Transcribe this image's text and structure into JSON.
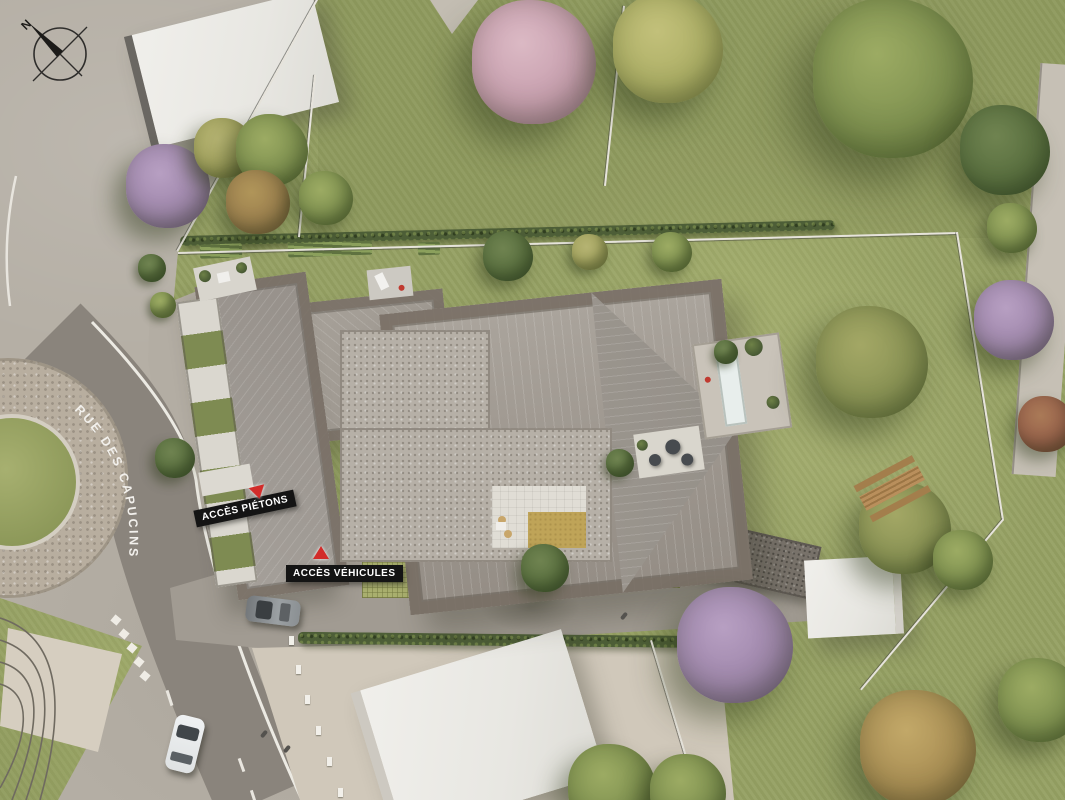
{
  "compass": {
    "letter": "N"
  },
  "street": {
    "name": "RUE DES CAPUCINS"
  },
  "access_labels": {
    "pedestrian": "ACCÈS PIÉTONS",
    "vehicle": "ACCÈS VÉHICULES"
  },
  "colors": {
    "road_asphalt": "#8a847c",
    "pavement": "#b5afa5",
    "sidewalk_beige": "#d0c8ba",
    "grass": "#96a164",
    "hedge": "#4d5e37",
    "roof_metal": "#a29c94",
    "roof_flat_gravel": "#b6b0a7",
    "permeable_paving": "#a9af6e",
    "lawn_square_yellow": "#bfa458",
    "marker_red": "#d22c2a",
    "label_bg": "#141414",
    "label_text": "#ffffff",
    "building_white": "#e9e8e4",
    "pool_water": "#e8eeec"
  },
  "scene": {
    "tree_palette": {
      "green": [
        "#7f9150",
        "#5c7038",
        "#9cab63"
      ],
      "darkgreen": [
        "#5a7040",
        "#3f5530",
        "#6f8350"
      ],
      "olive": [
        "#a3a35f",
        "#7e8447",
        "#b5b372"
      ],
      "brown": [
        "#9b7f4e",
        "#7a5f3a",
        "#b09559"
      ],
      "purple": [
        "#9f87ab",
        "#7c6488",
        "#b79fc2"
      ],
      "pink": [
        "#c79fae",
        "#a87f93",
        "#dbb9c4"
      ],
      "yellowgreen": [
        "#adaf66",
        "#8a8e4d",
        "#c2c07a"
      ],
      "autumn": [
        "#a98e54",
        "#82683c",
        "#c2a868"
      ],
      "red": [
        "#96604a",
        "#744936",
        "#aa7a57"
      ],
      "mixed": [
        "#8a9355",
        "#67763f",
        "#a3a765"
      ]
    },
    "trees": [
      {
        "x": 168,
        "y": 186,
        "r": 42,
        "t": "purple"
      },
      {
        "x": 224,
        "y": 148,
        "r": 30,
        "t": "olive"
      },
      {
        "x": 272,
        "y": 150,
        "r": 36,
        "t": "green"
      },
      {
        "x": 258,
        "y": 202,
        "r": 32,
        "t": "brown"
      },
      {
        "x": 326,
        "y": 198,
        "r": 27,
        "t": "green"
      },
      {
        "x": 534,
        "y": 62,
        "r": 62,
        "t": "pink"
      },
      {
        "x": 668,
        "y": 48,
        "r": 55,
        "t": "yellowgreen"
      },
      {
        "x": 893,
        "y": 78,
        "r": 80,
        "t": "green"
      },
      {
        "x": 1005,
        "y": 150,
        "r": 45,
        "t": "darkgreen"
      },
      {
        "x": 1012,
        "y": 228,
        "r": 25,
        "t": "green"
      },
      {
        "x": 1014,
        "y": 320,
        "r": 40,
        "t": "purple"
      },
      {
        "x": 1046,
        "y": 424,
        "r": 28,
        "t": "red"
      },
      {
        "x": 508,
        "y": 256,
        "r": 25,
        "t": "darkgreen"
      },
      {
        "x": 590,
        "y": 252,
        "r": 18,
        "t": "olive"
      },
      {
        "x": 672,
        "y": 252,
        "r": 20,
        "t": "green"
      },
      {
        "x": 872,
        "y": 362,
        "r": 56,
        "t": "mixed"
      },
      {
        "x": 905,
        "y": 528,
        "r": 46,
        "t": "mixed"
      },
      {
        "x": 963,
        "y": 560,
        "r": 30,
        "t": "green"
      },
      {
        "x": 735,
        "y": 645,
        "r": 58,
        "t": "purple"
      },
      {
        "x": 612,
        "y": 788,
        "r": 44,
        "t": "green"
      },
      {
        "x": 688,
        "y": 792,
        "r": 38,
        "t": "green"
      },
      {
        "x": 918,
        "y": 748,
        "r": 58,
        "t": "autumn"
      },
      {
        "x": 1040,
        "y": 700,
        "r": 42,
        "t": "green"
      },
      {
        "x": 175,
        "y": 458,
        "r": 20,
        "t": "darkgreen"
      },
      {
        "x": 152,
        "y": 268,
        "r": 14,
        "t": "darkgreen"
      },
      {
        "x": 163,
        "y": 305,
        "r": 13,
        "t": "green"
      },
      {
        "x": 545,
        "y": 568,
        "r": 24,
        "t": "darkgreen"
      },
      {
        "x": 620,
        "y": 463,
        "r": 14,
        "t": "darkgreen"
      },
      {
        "x": 726,
        "y": 352,
        "r": 12,
        "t": "darkgreen"
      }
    ],
    "skylights": [
      {
        "x": 505,
        "y": 316
      },
      {
        "x": 425,
        "y": 316
      },
      {
        "x": 612,
        "y": 316
      },
      {
        "x": 656,
        "y": 318
      },
      {
        "x": 717,
        "y": 348
      },
      {
        "x": 570,
        "y": 460
      },
      {
        "x": 612,
        "y": 460
      },
      {
        "x": 262,
        "y": 430
      },
      {
        "x": 312,
        "y": 430
      }
    ],
    "fences": [
      {
        "x1": 178,
        "y1": 252,
        "x2": 958,
        "y2": 232
      },
      {
        "x1": 958,
        "y1": 232,
        "x2": 1004,
        "y2": 520
      },
      {
        "x1": 1004,
        "y1": 520,
        "x2": 862,
        "y2": 690
      },
      {
        "x1": 652,
        "y1": 640,
        "x2": 700,
        "y2": 800
      },
      {
        "x1": 316,
        "y1": 75,
        "x2": 300,
        "y2": 237
      },
      {
        "x1": 625,
        "y1": 6,
        "x2": 606,
        "y2": 186
      },
      {
        "x1": 318,
        "y1": 0,
        "x2": 178,
        "y2": 252
      }
    ],
    "garden_beds": [
      {
        "x": 200,
        "y": 244,
        "w": 42,
        "h": 14
      },
      {
        "x": 288,
        "y": 242,
        "w": 84,
        "h": 14
      },
      {
        "x": 418,
        "y": 242,
        "w": 22,
        "h": 13
      }
    ],
    "fence_posts": [
      {
        "x": 289,
        "y": 636
      },
      {
        "x": 296,
        "y": 665
      },
      {
        "x": 305,
        "y": 695
      },
      {
        "x": 316,
        "y": 726
      },
      {
        "x": 327,
        "y": 757
      },
      {
        "x": 338,
        "y": 788
      }
    ],
    "road_checkers": [
      {
        "x": 112,
        "y": 616
      },
      {
        "x": 120,
        "y": 630
      },
      {
        "x": 128,
        "y": 644
      },
      {
        "x": 135,
        "y": 658
      },
      {
        "x": 141,
        "y": 672
      }
    ],
    "road_dashes": [
      {
        "x": 168,
        "y": 690,
        "a": 72,
        "l": 16
      },
      {
        "x": 178,
        "y": 722,
        "a": 74,
        "l": 16
      },
      {
        "x": 188,
        "y": 754,
        "a": 76,
        "l": 16
      },
      {
        "x": 240,
        "y": 758,
        "a": 70,
        "l": 14
      },
      {
        "x": 252,
        "y": 790,
        "a": 72,
        "l": 14
      }
    ],
    "pedestrians": [
      {
        "x": 262,
        "y": 730
      },
      {
        "x": 285,
        "y": 745
      },
      {
        "x": 622,
        "y": 612
      }
    ]
  }
}
